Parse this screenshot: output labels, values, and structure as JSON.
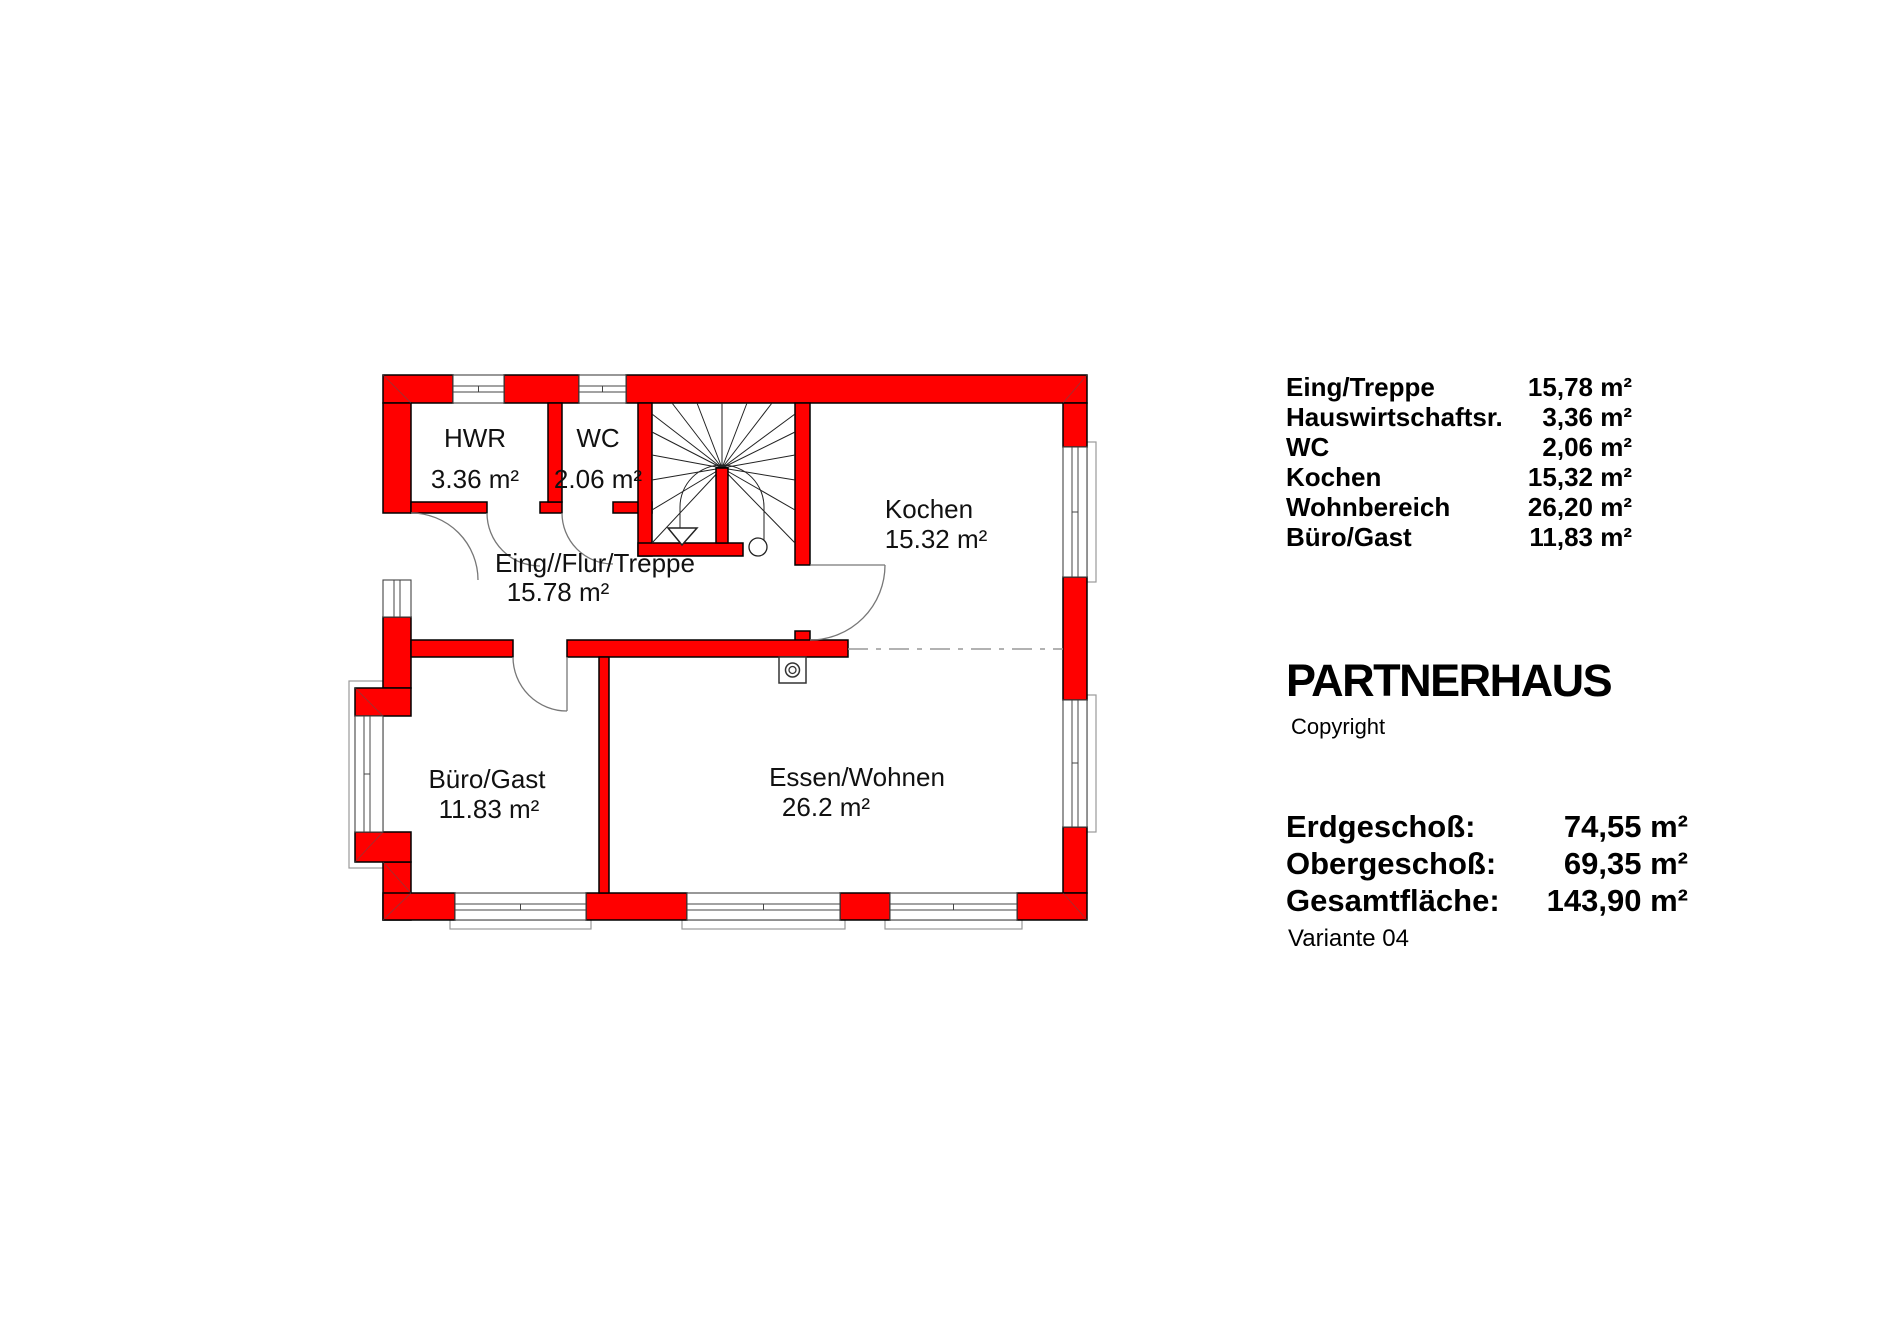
{
  "plan": {
    "rooms": [
      {
        "name": "HWR",
        "area": "3.36 m²"
      },
      {
        "name": "WC",
        "area": "2.06 m²"
      },
      {
        "name": "Eing//Flur/Treppe",
        "area": "15.78 m²"
      },
      {
        "name": "Kochen",
        "area": "15.32 m²"
      },
      {
        "name": "Büro/Gast",
        "area": "11.83 m²"
      },
      {
        "name": "Essen/Wohnen",
        "area": "26.2 m²"
      }
    ]
  },
  "panel": {
    "room_list": [
      {
        "label": "Eing/Treppe",
        "value": "15,78 m²"
      },
      {
        "label": "Hauswirtschaftsr.",
        "value": "3,36 m²"
      },
      {
        "label": "WC",
        "value": "2,06 m²"
      },
      {
        "label": "Kochen",
        "value": "15,32 m²"
      },
      {
        "label": "Wohnbereich",
        "value": "26,20 m²"
      },
      {
        "label": "Büro/Gast",
        "value": "11,83 m²"
      }
    ],
    "brand": {
      "title": "PARTNERHAUS",
      "copyright": "Copyright"
    },
    "totals": [
      {
        "label": "Erdgeschoß:",
        "value": "74,55 m²"
      },
      {
        "label": "Obergeschoß:",
        "value": "69,35 m²"
      },
      {
        "label": "Gesamtfläche:",
        "value": "143,90 m²"
      }
    ],
    "variant": "Variante 04"
  },
  "colors": {
    "wall_red": "#ff0000",
    "wall_outline": "#000000",
    "window_line": "#444444",
    "door_arc": "#777777",
    "centerline_gray": "#999999",
    "label_text": "#111111"
  }
}
